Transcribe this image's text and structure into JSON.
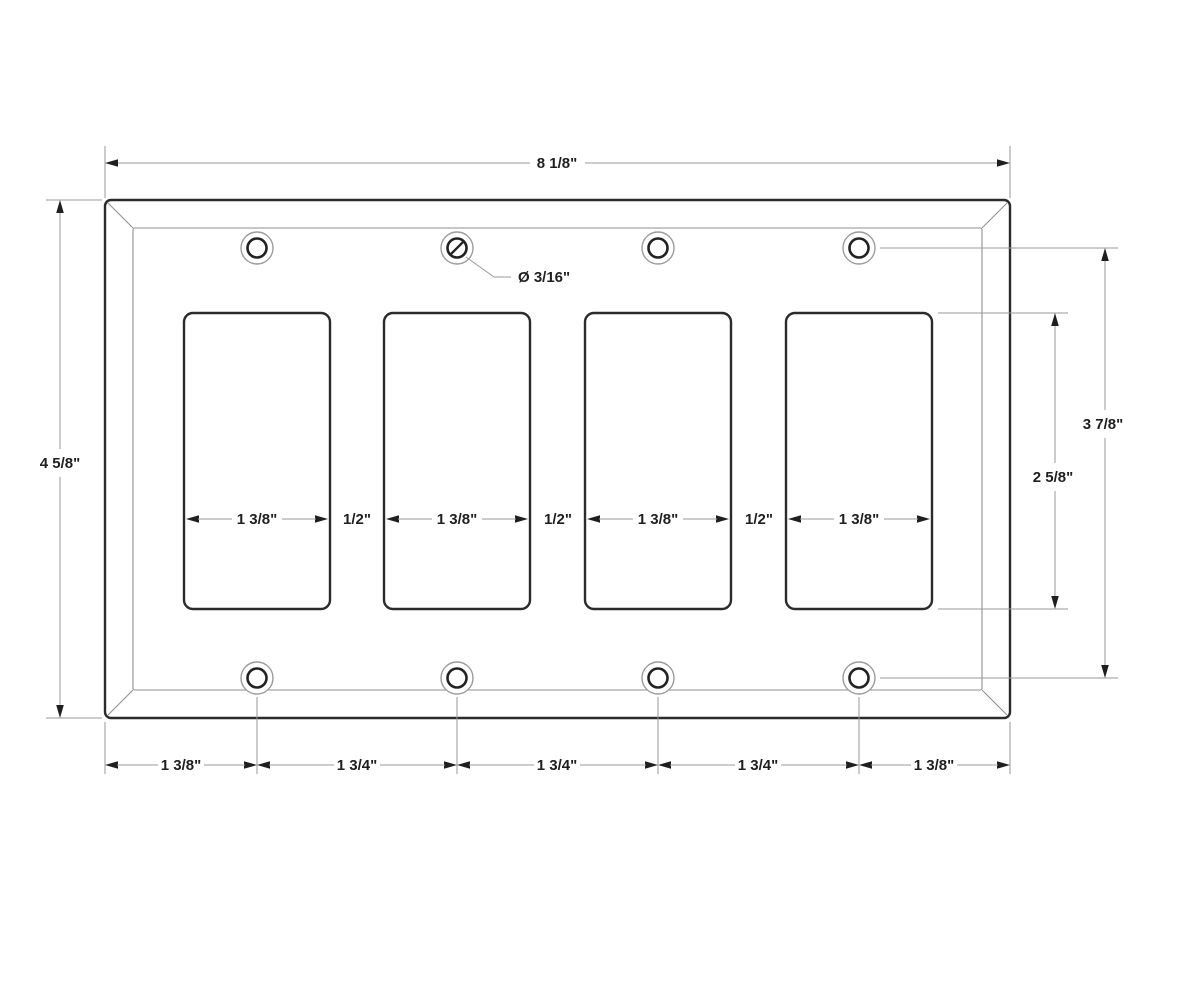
{
  "diagram": {
    "subject": "four-gang-rocker-wallplate-dimension-drawing",
    "cutout_count": 4,
    "screw_hole_count": 8,
    "colors": {
      "background": "#ffffff",
      "plate_outline": "#2b2b2b",
      "dimension_lines": "#9a9a9a",
      "text": "#1f1f1f"
    }
  },
  "dimensions": {
    "overall_width": "8 1/8\"",
    "overall_height": "4 5/8\"",
    "screw_hole_diameter": "Ø 3/16\"",
    "screw_center_span": "3 7/8\"",
    "cutout_height": "2 5/8\"",
    "cutout_width": "1 3/8\"",
    "gap_between_cutouts": "1/2\"",
    "bottom_spacing": [
      "1 3/8\"",
      "1 3/4\"",
      "1 3/4\"",
      "1 3/4\"",
      "1 3/8\""
    ]
  }
}
